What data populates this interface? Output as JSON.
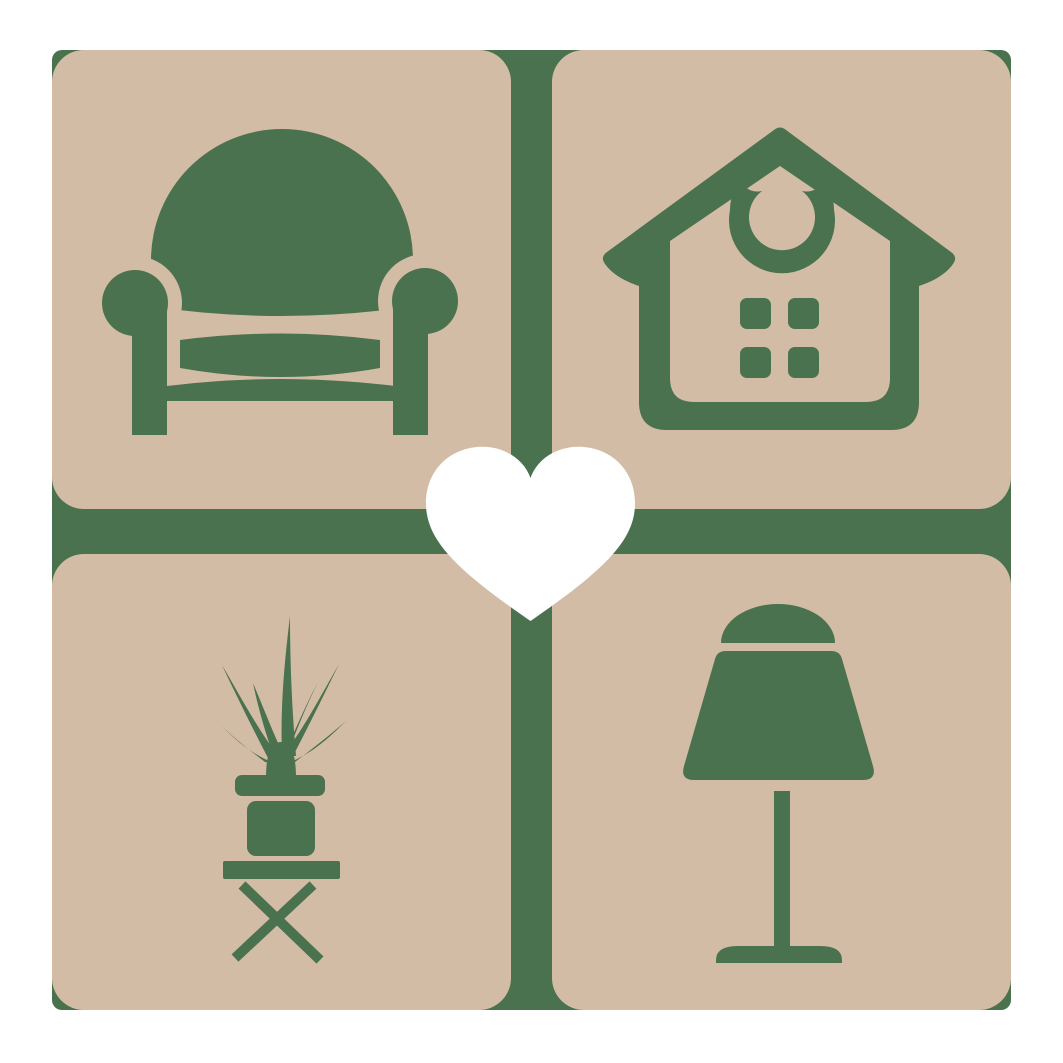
{
  "logo": {
    "type": "logo",
    "description": "Four-tile home decor logo: armchair, house, potted plant and table lamp on tan rounded tiles over a green cross, with a white heart in the center",
    "colors": {
      "background": "#ffffff",
      "tile": "#d3bca5",
      "glyph": "#4a724e",
      "heart": "#ffffff"
    },
    "tiles": [
      {
        "id": "armchair",
        "label": "Armchair",
        "position": "top-left"
      },
      {
        "id": "house",
        "label": "House",
        "position": "top-right"
      },
      {
        "id": "potted-plant",
        "label": "Potted plant on stool",
        "position": "bottom-left"
      },
      {
        "id": "table-lamp",
        "label": "Table lamp",
        "position": "bottom-right"
      }
    ],
    "center": {
      "id": "heart",
      "label": "Heart"
    }
  }
}
